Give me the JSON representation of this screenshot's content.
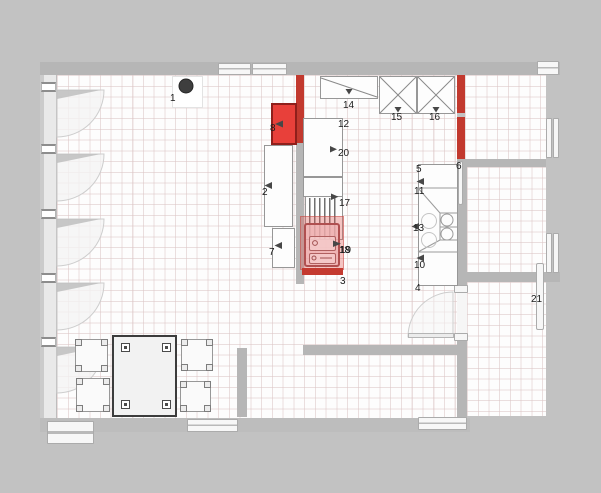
{
  "colors": {
    "background": "#c2c2c2",
    "wall": "#b6b6b6",
    "wall_red": "#c2392e",
    "appliance_red": "#e8403a",
    "stove_highlight_fill": "rgba(226,88,84,0.35)",
    "stove_plinth_red": "#c43a30",
    "grid_line": "#dbc4c4",
    "label_color": "#1b1b1b",
    "lamp_color": "#3e3e3e"
  },
  "labels": [
    {
      "id": "item-1",
      "text": "1"
    },
    {
      "id": "item-2",
      "text": "2"
    },
    {
      "id": "item-3",
      "text": "3"
    },
    {
      "id": "item-4",
      "text": "4"
    },
    {
      "id": "item-5",
      "text": "5"
    },
    {
      "id": "item-6",
      "text": "6"
    },
    {
      "id": "item-7",
      "text": "7"
    },
    {
      "id": "item-8",
      "text": "8"
    },
    {
      "id": "item-10",
      "text": "10"
    },
    {
      "id": "item-11",
      "text": "11"
    },
    {
      "id": "item-12",
      "text": "12"
    },
    {
      "id": "item-13",
      "text": "13"
    },
    {
      "id": "item-14",
      "text": "14"
    },
    {
      "id": "item-15",
      "text": "15"
    },
    {
      "id": "item-16",
      "text": "16"
    },
    {
      "id": "item-17",
      "text": "17"
    },
    {
      "id": "item-18",
      "text": "18"
    },
    {
      "id": "item-19",
      "text": "19"
    },
    {
      "id": "item-20",
      "text": "20"
    },
    {
      "id": "item-21",
      "text": "21"
    }
  ]
}
